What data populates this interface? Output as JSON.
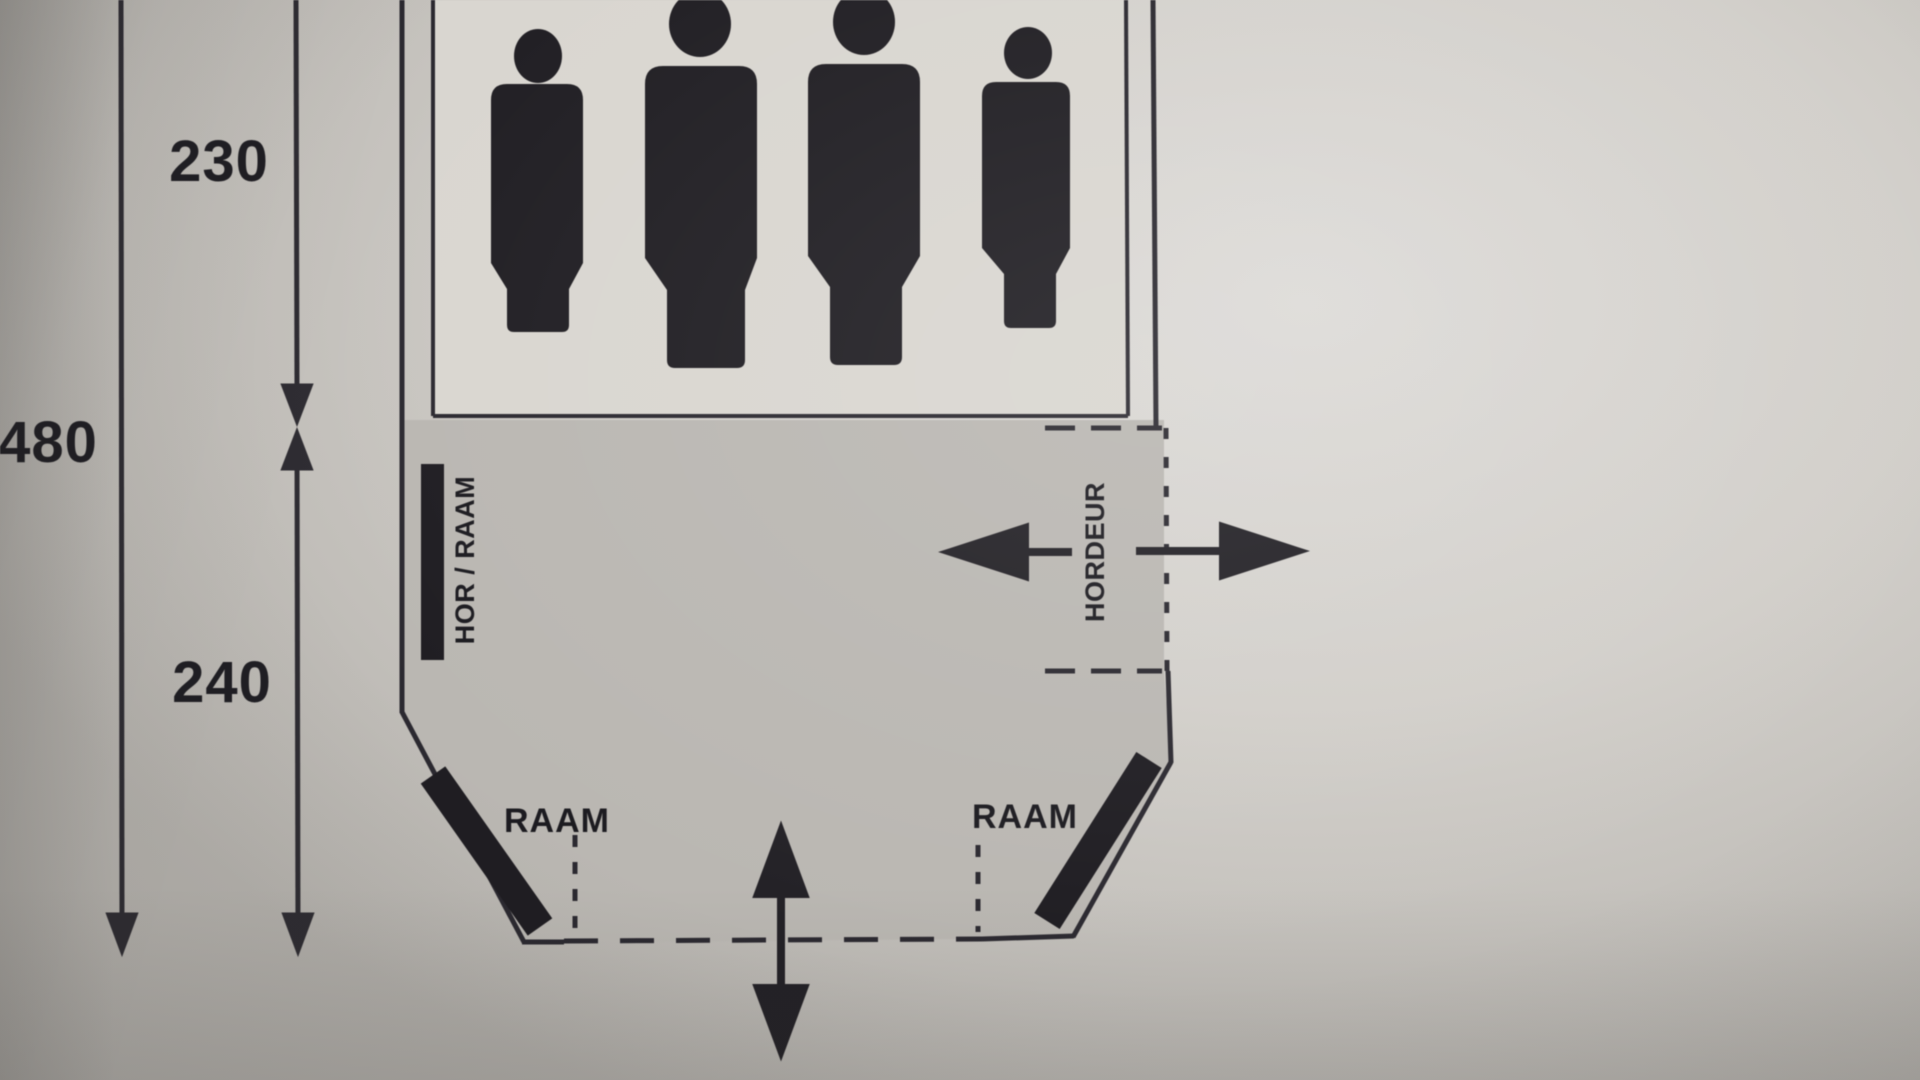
{
  "diagram": {
    "kind": "tent floor plan (photographed print)",
    "persons_capacity": 4,
    "dimensions": {
      "total_depth": "480",
      "cabin_depth": "230",
      "living_depth": "240"
    },
    "labels": {
      "left_screen_window": "HOR / RAAM",
      "screen_door": "HORDEUR",
      "front_window_left": "RAAM",
      "front_window_right": "RAAM"
    },
    "colors": {
      "paper": "#d2cfca",
      "cabin_fill": "#dad7d1",
      "living_fill": "#bab7b2",
      "ink": "#2b2930"
    }
  }
}
